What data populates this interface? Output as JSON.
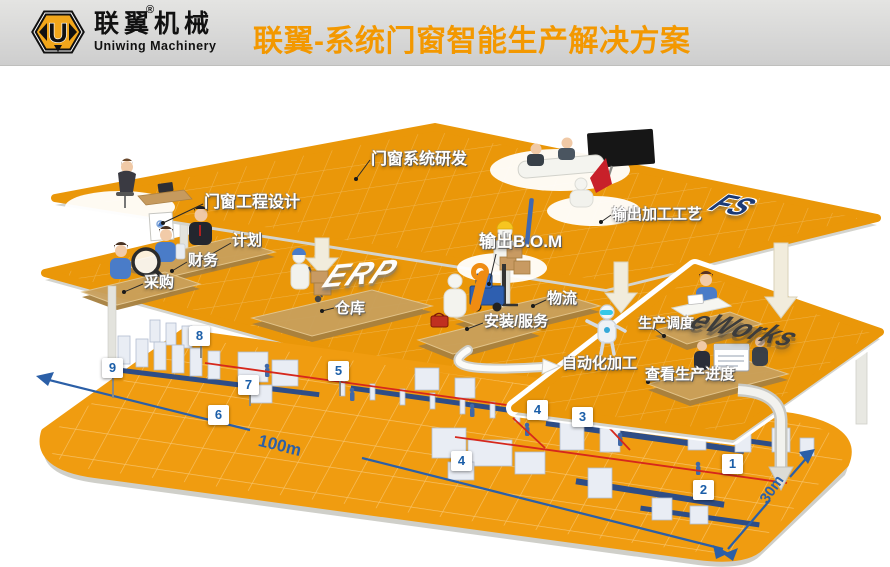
{
  "header": {
    "brand": "联翼机械",
    "brand_en": "Uniwing Machinery",
    "reg_mark": "®",
    "logo_letter": "U",
    "title": "联翼-系统门窗智能生产解决方案"
  },
  "layers": {
    "ps": {
      "logo": "FS",
      "labels": {
        "design": "门窗工程设计",
        "rd": "门窗系统研发",
        "bom": "输出B.O.M",
        "process": "输出加工工艺"
      }
    },
    "erp": {
      "logo": "ERP",
      "labels": {
        "plan": "计划",
        "finance": "财务",
        "purchase": "采购",
        "warehouse": "仓库",
        "logistics": "物流",
        "install": "安装/服务"
      }
    },
    "eworks": {
      "logo": "eWorks",
      "labels": {
        "dispatch": "生产调度",
        "auto": "自动化加工",
        "progress": "查看生产进度"
      }
    }
  },
  "floor": {
    "badges": [
      {
        "n": "1"
      },
      {
        "n": "2"
      },
      {
        "n": "3"
      },
      {
        "n": "4"
      },
      {
        "n": "4"
      },
      {
        "n": "5"
      },
      {
        "n": "6"
      },
      {
        "n": "7"
      },
      {
        "n": "8"
      },
      {
        "n": "9"
      }
    ],
    "dim_length": "100m",
    "dim_width": "30m"
  },
  "colors": {
    "title_orange": "#f39800",
    "platform_orange": "#ea9709",
    "floor_orange": "#f09c10",
    "dim_blue": "#2b5fa7",
    "rail_red": "#d6281c",
    "badge_blue": "#1b5ea8",
    "podium_tan": "#c9a05c"
  }
}
